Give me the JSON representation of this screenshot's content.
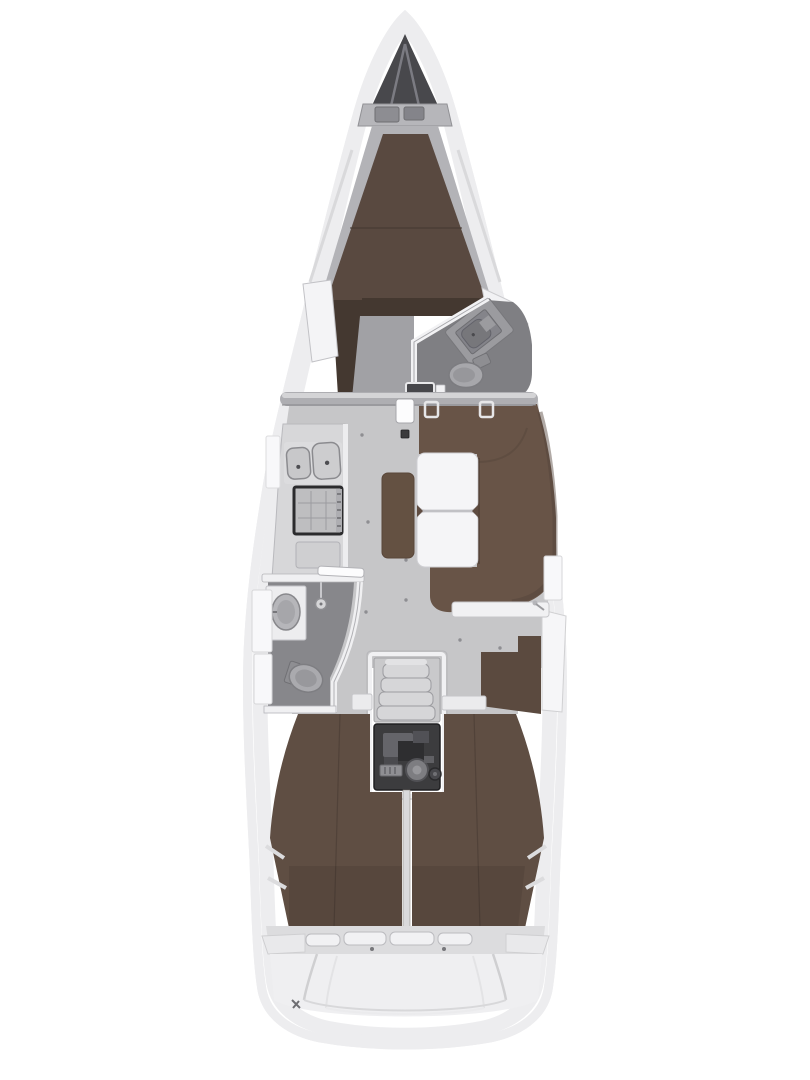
{
  "diagram": {
    "type": "sailing-yacht-interior-floor-plan",
    "orientation": "bow-up",
    "compartments": [
      "anchor-locker",
      "forward-cabin-v-berth",
      "forward-head",
      "main-bulkhead",
      "saloon",
      "galley",
      "aft-head",
      "settee-with-table",
      "navigation-station",
      "companionway-stairs",
      "engine-room",
      "port-aft-cabin",
      "starboard-aft-cabin",
      "transom"
    ]
  },
  "colors": {
    "background": "#ffffff",
    "hull_fill": "#fdfdfe",
    "hull_outline": "#c6c6ca",
    "hull_glow": "#ededef",
    "deck_line": "#d6d6d8",
    "deck_line_inner": "#e8e8ea",
    "anchor_locker": "#48484c",
    "locker_divider": "#7b7b82",
    "bow_shelf": "#b6b6ba",
    "bow_box": "#8d8d92",
    "berth_base": "#b3b3b7",
    "forward_berth": "#594940",
    "berth_seam": "#453931",
    "dark_cabinet": "#443830",
    "forward_floor": "#a1a1a5",
    "white_furniture": "#f4f4f6",
    "furniture_edge": "#c6c6ca",
    "forward_head_floor": "#7f7f83",
    "aft_head_floor": "#87878b",
    "fixture": "#9b9b9f",
    "fixture_dark": "#84848a",
    "toilet": "#a7a7ab",
    "bulkhead_beam": "#aeaeb2",
    "beam_highlight": "#d4d4d6",
    "saloon_floor": "#c6c6c8",
    "floor_dot": "#8e8e92",
    "galley_counter": "#d7d7d9",
    "sink": "#c8c8ca",
    "stove_frame": "#2b2b2d",
    "stove_face": "#bebec0",
    "settee": "#685447",
    "settee_shade": "#53433a",
    "chaise": "#645142",
    "table": "#f5f5f7",
    "table_edge": "#cfcfd3",
    "nav_shelf": "#f1f1f3",
    "nav_seat": "#5b4a3f",
    "stair": "#d6d6d8",
    "stair_base": "#c9c9cb",
    "engine_floor": "#3c3c3e",
    "engine_light": "#8f8f93",
    "engine_mid": "#65656a",
    "engine_dark": "#2e2e30",
    "engine_wheel": "#7d7d81",
    "aft_berth": "#5f4e43",
    "berth_divider": "#d9d9db",
    "stern_band": "#dcdcde",
    "hatch": "#f1f1f3",
    "transom": "#efeff1",
    "transom_line": "#cfcfd1",
    "wall_white": "#f0f0f2",
    "wall_edge": "#b2b2b6",
    "shower": "#d6d6d8"
  }
}
